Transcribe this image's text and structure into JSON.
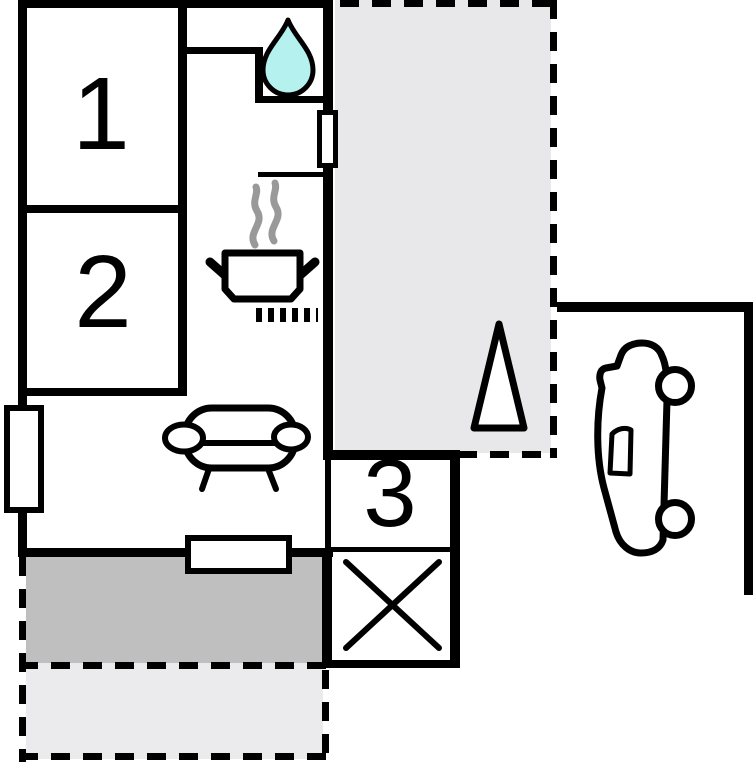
{
  "plan": {
    "type": "apartment-floor-plan",
    "rooms": [
      {
        "id": "room-1",
        "label": "1"
      },
      {
        "id": "room-2",
        "label": "2"
      },
      {
        "id": "room-3",
        "label": "3"
      }
    ],
    "symbols": [
      "water-drop-icon",
      "steam-icon",
      "stove-pot-icon",
      "grill-dashes-icon",
      "sofa-icon",
      "cross-icon",
      "tree-icon",
      "car-icon",
      "window-marker"
    ],
    "areas": [
      "terrace",
      "covered-patio",
      "open-patio",
      "parking"
    ],
    "colors": {
      "wall": "#000000",
      "water_drop": "#b5f1ee",
      "terrace": "#e8e8ea",
      "covered_patio": "#bfbfbf",
      "open_patio": "#ebebed",
      "steam": "#999999",
      "background": "#ffffff"
    }
  }
}
